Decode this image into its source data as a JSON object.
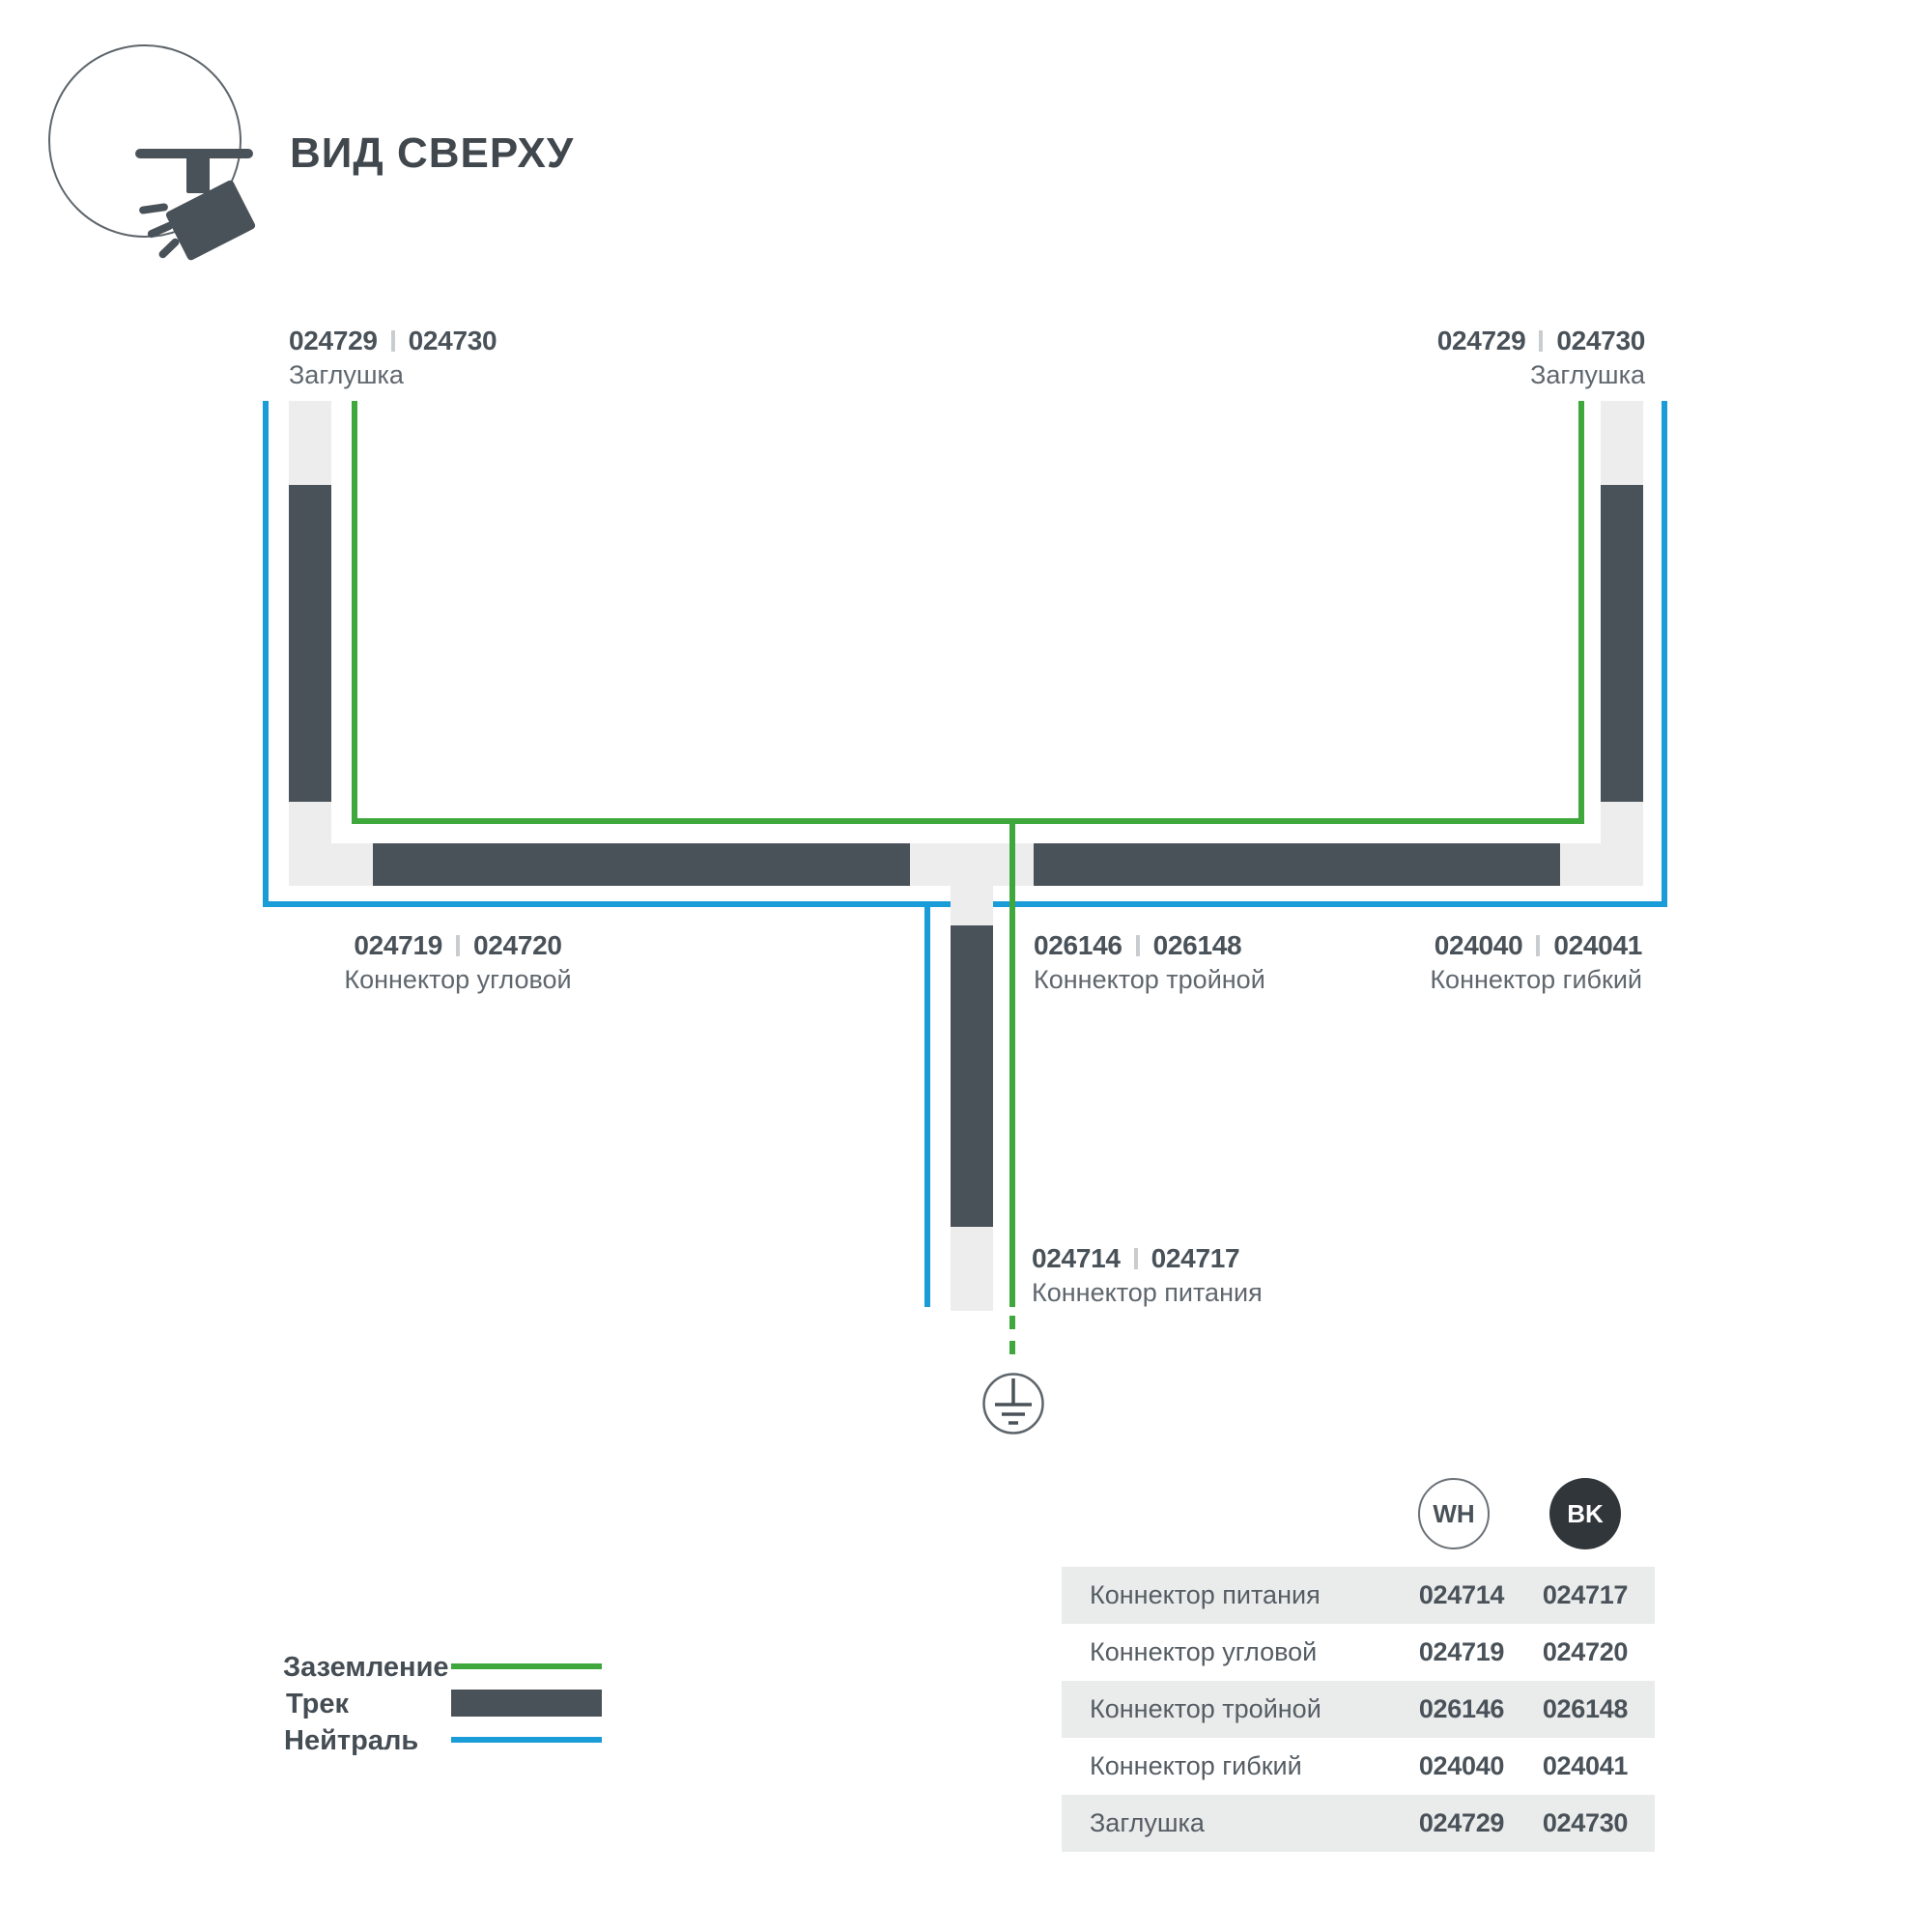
{
  "title": "ВИД СВЕРХУ",
  "diagram": {
    "labels": {
      "cap_left": {
        "wh": "024729",
        "bk": "024730",
        "name": "Заглушка"
      },
      "cap_right": {
        "wh": "024729",
        "bk": "024730",
        "name": "Заглушка"
      },
      "corner": {
        "wh": "024719",
        "bk": "024720",
        "name": "Коннектор угловой"
      },
      "triple": {
        "wh": "026146",
        "bk": "026148",
        "name": "Коннектор тройной"
      },
      "flex": {
        "wh": "024040",
        "bk": "024041",
        "name": "Коннектор гибкий"
      },
      "power": {
        "wh": "024714",
        "bk": "024717",
        "name": "Коннектор питания"
      }
    }
  },
  "legend": {
    "ground": "Заземление",
    "track": "Трек",
    "neutral": "Нейтраль"
  },
  "table": {
    "columns": {
      "wh": "WH",
      "bk": "BK"
    },
    "rows": [
      {
        "name": "Коннектор питания",
        "wh": "024714",
        "bk": "024717"
      },
      {
        "name": "Коннектор угловой",
        "wh": "024719",
        "bk": "024720"
      },
      {
        "name": "Коннектор тройной",
        "wh": "026146",
        "bk": "026148"
      },
      {
        "name": "Коннектор гибкий",
        "wh": "024040",
        "bk": "024041"
      },
      {
        "name": "Заглушка",
        "wh": "024729",
        "bk": "024730"
      }
    ]
  },
  "colors": {
    "ground_green": "#3fa83c",
    "neutral_blue": "#1a9cd8",
    "track_dark": "#4a5259",
    "rail_light": "#ededee"
  }
}
